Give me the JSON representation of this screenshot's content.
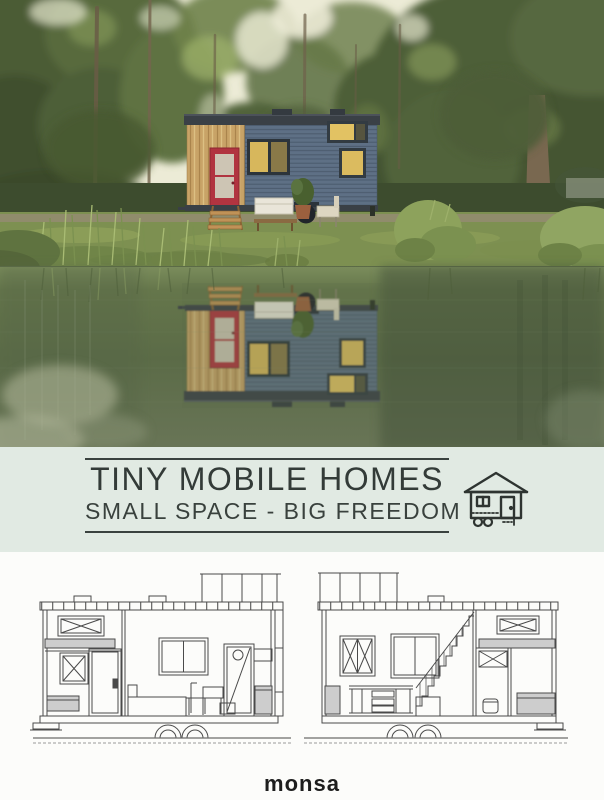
{
  "cover": {
    "title": "TINY MOBILE HOMES",
    "subtitle": "SMALL SPACE - BIG FREEDOM",
    "publisher": "monsa",
    "icons": {
      "tiny_house_icon": "tiny-house-on-wheels"
    },
    "colors": {
      "title_band_background": "#e1eae3",
      "title_text": "#333b38",
      "door_red": "#b13440",
      "house_siding_blue": "#5e7085",
      "house_wood_tan": "#c8a367",
      "water_green": "#5c6c48",
      "plan_line_gray": "#4a4a4a",
      "plan_fill_gray": "#cdcdcd",
      "publisher_black": "#1d1d1d"
    }
  }
}
